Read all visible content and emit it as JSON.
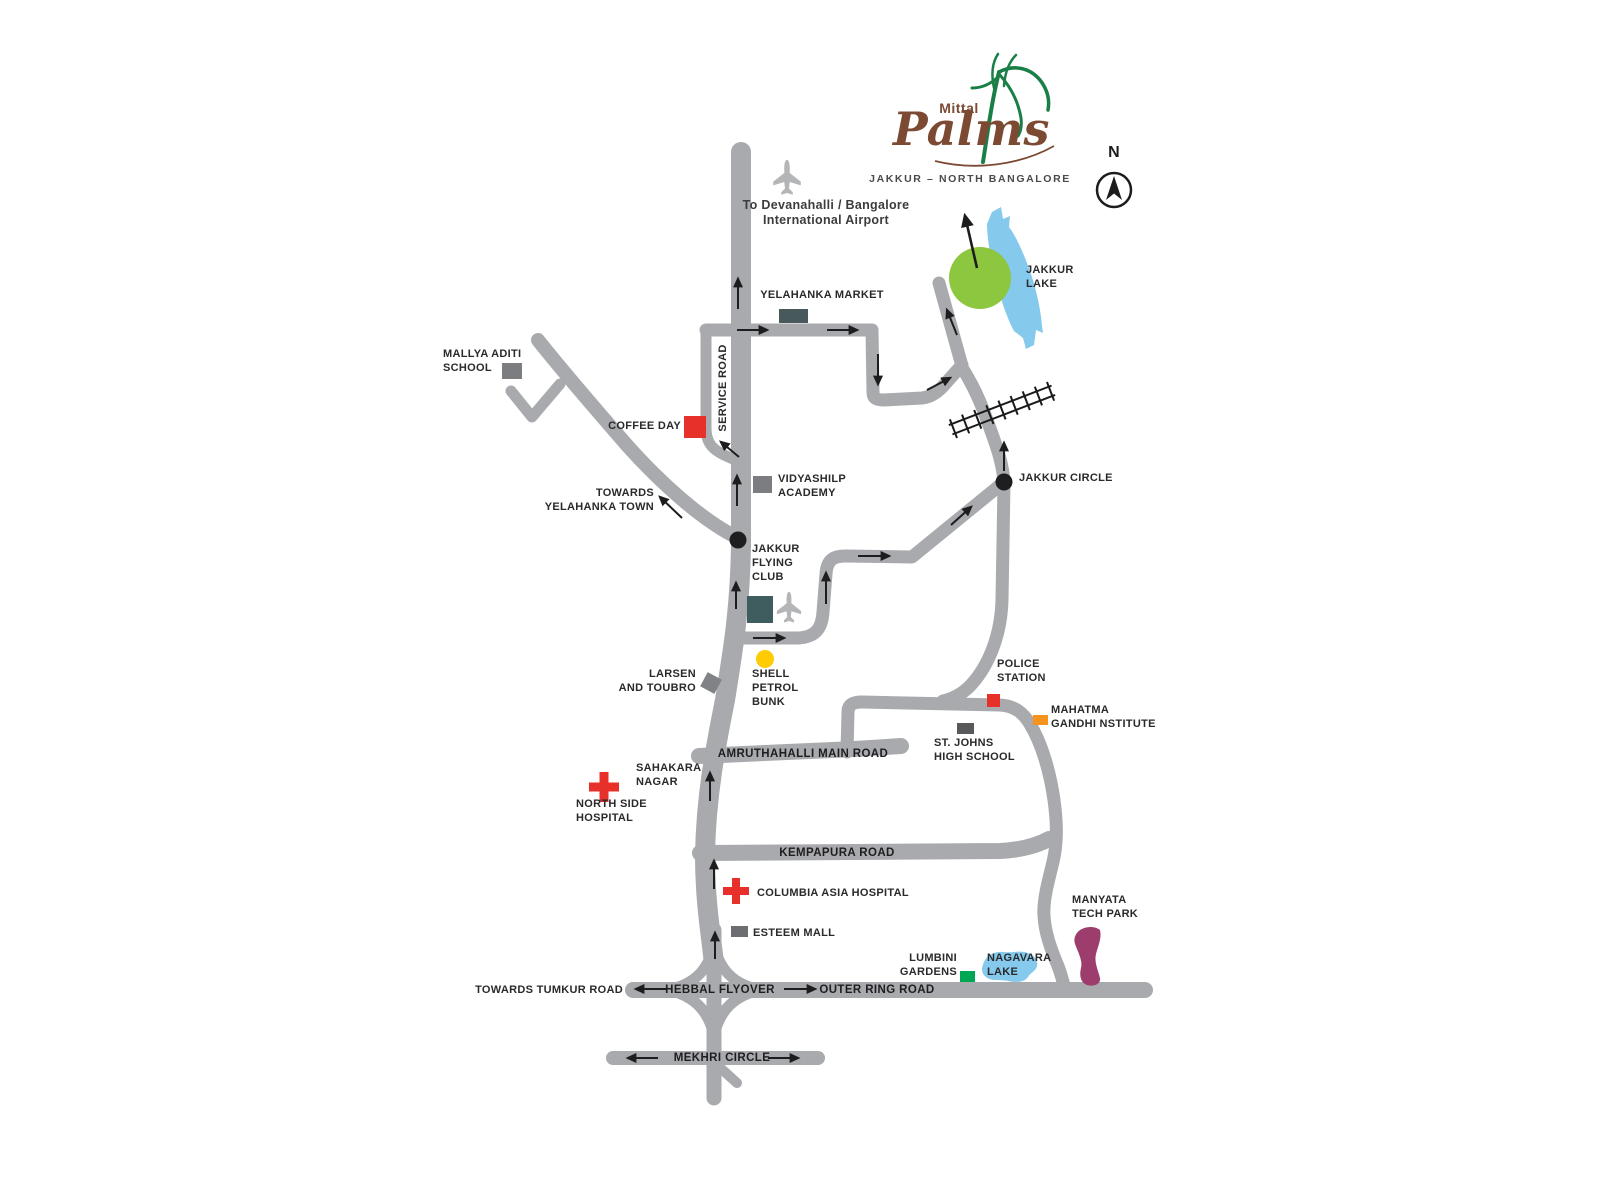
{
  "logo": {
    "brand": "Mittal",
    "script": "Palms",
    "tagline": "JAKKUR – NORTH BANGALORE"
  },
  "compass": {
    "north": "N"
  },
  "colors": {
    "road": "#a8aaad",
    "lake_blue": "#85c9ec",
    "site_green": "#8dc63f",
    "marker_red": "#e8302a",
    "shell_yellow": "#ffcb05",
    "mg_orange": "#f7941d",
    "lumbini_green": "#00a651",
    "manyata_purple": "#9c3d6e",
    "slate_dark": "#47595b",
    "slate_mid": "#58595b",
    "gray_marker": "#7b7d80",
    "teal_dark": "#3f5c5e",
    "esteem_gray": "#6d6e71",
    "lt_gray": "#808285",
    "brand_brown": "#7c4a33",
    "leaf_green": "#1a7f46"
  },
  "labels": {
    "airport_note": {
      "text": "To Devanahalli / Bangalore\nInternational Airport"
    },
    "yelahanka_market": {
      "text": "YELAHANKA MARKET"
    },
    "mallya": {
      "text": "MALLYA ADITI\nSCHOOL"
    },
    "coffee_day": {
      "text": "COFFEE DAY"
    },
    "service_road": {
      "text": "SERVICE ROAD"
    },
    "towards_yelahanka": {
      "text": "TOWARDS\nYELAHANKA TOWN"
    },
    "vidyashilp": {
      "text": "VIDYASHILP\nACADEMY"
    },
    "jakkur_circle": {
      "text": "JAKKUR CIRCLE"
    },
    "jakkur_lake": {
      "text": "JAKKUR\nLAKE"
    },
    "jakkur_flying_club": {
      "text": "JAKKUR\nFLYING\nCLUB"
    },
    "shell_petrol": {
      "text": "SHELL\nPETROL\nBUNK"
    },
    "larsen_toubro": {
      "text": "LARSEN\nAND TOUBRO"
    },
    "amruthahalli_road": {
      "text": "AMRUTHAHALLI MAIN ROAD"
    },
    "sahakara_nagar": {
      "text": "SAHAKARA\nNAGAR"
    },
    "north_side_hospital": {
      "text": "NORTH SIDE\nHOSPITAL"
    },
    "police_station": {
      "text": "POLICE\nSTATION"
    },
    "mahatma_gandhi": {
      "text": "MAHATMA\nGANDHI NSTITUTE"
    },
    "st_johns": {
      "text": "ST. JOHNS\nHIGH SCHOOL"
    },
    "kempapura_road": {
      "text": "KEMPAPURA ROAD"
    },
    "columbia_asia": {
      "text": "COLUMBIA ASIA HOSPITAL"
    },
    "esteem_mall": {
      "text": "ESTEEM MALL"
    },
    "manyata": {
      "text": "MANYATA\nTECH PARK"
    },
    "lumbini": {
      "text": "LUMBINI\nGARDENS"
    },
    "nagavara": {
      "text": "NAGAVARA\nLAKE"
    },
    "towards_tumkur": {
      "text": "TOWARDS TUMKUR ROAD"
    },
    "hebbal_flyover": {
      "text": "HEBBAL FLYOVER"
    },
    "outer_ring_road": {
      "text": "OUTER RING ROAD"
    },
    "mekhri_circle": {
      "text": "MEKHRI CIRCLE"
    }
  }
}
